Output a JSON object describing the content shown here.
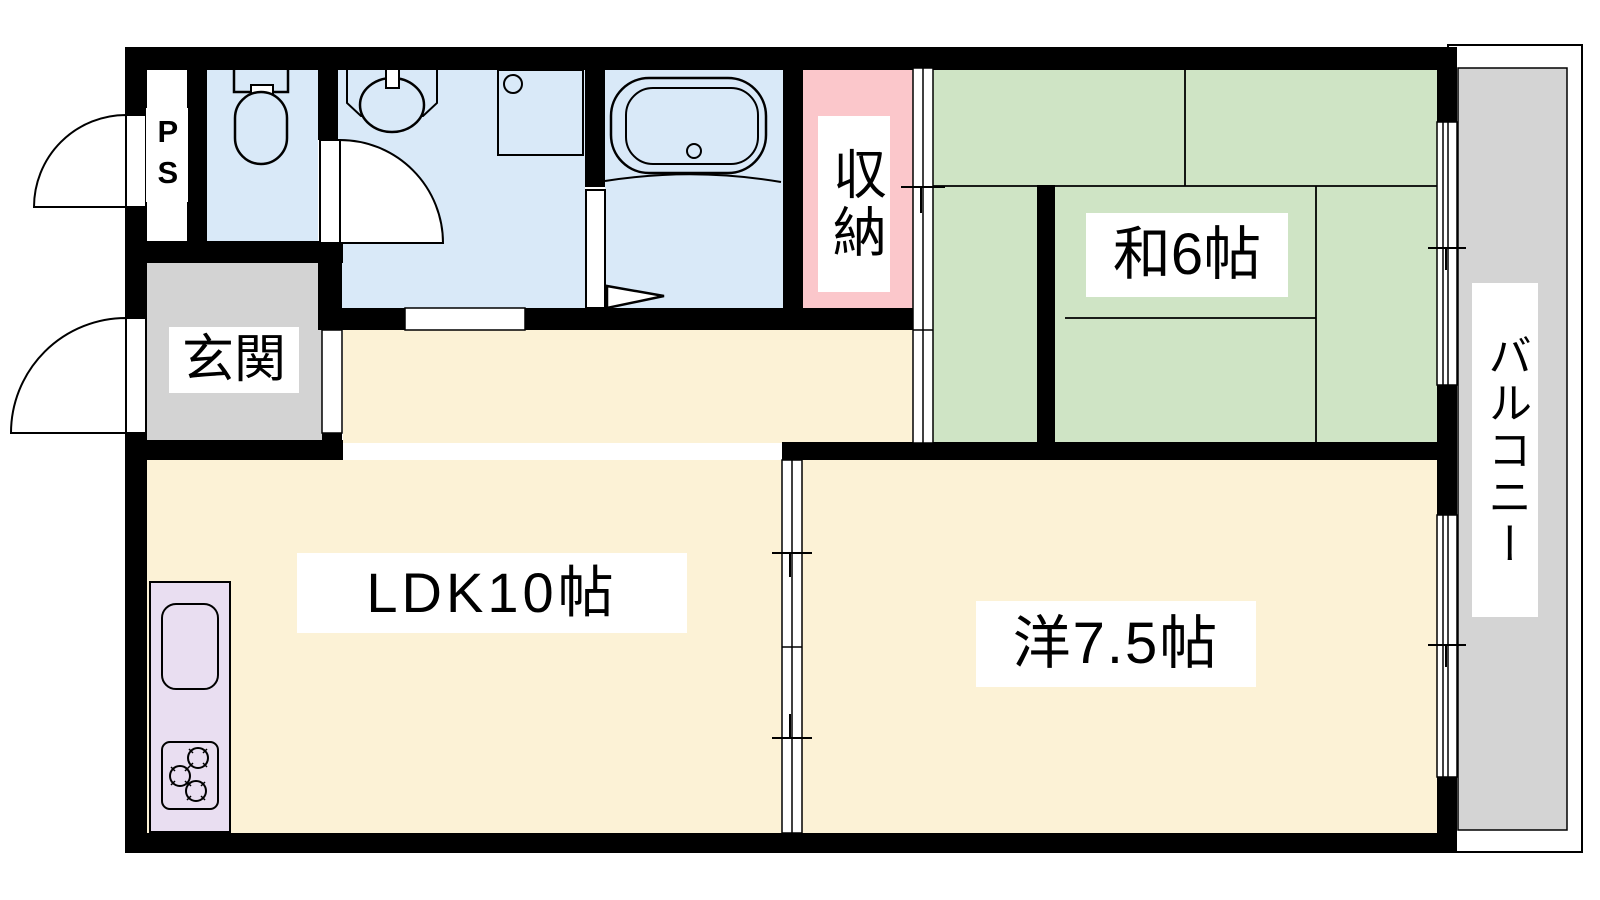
{
  "plan": {
    "type": "apartment floor plan",
    "labels": {
      "ps": "PS",
      "entrance": "玄関",
      "storage": "収納",
      "japanese_room": "和6帖",
      "ldk": "LDK10帖",
      "western_room": "洋7.5帖",
      "balcony": "バルコニー"
    },
    "colors": {
      "wall": "#000000",
      "water": "#d9e9f8",
      "tatami": "#cfe4c5",
      "room": "#fcf2d6",
      "storage": "#fbc7cb",
      "kitchen": "#e9def1",
      "entrance": "#d3d3d3",
      "balcony": "#d4d4d4",
      "label_bg": "#ffffff",
      "text": "#000000"
    }
  }
}
